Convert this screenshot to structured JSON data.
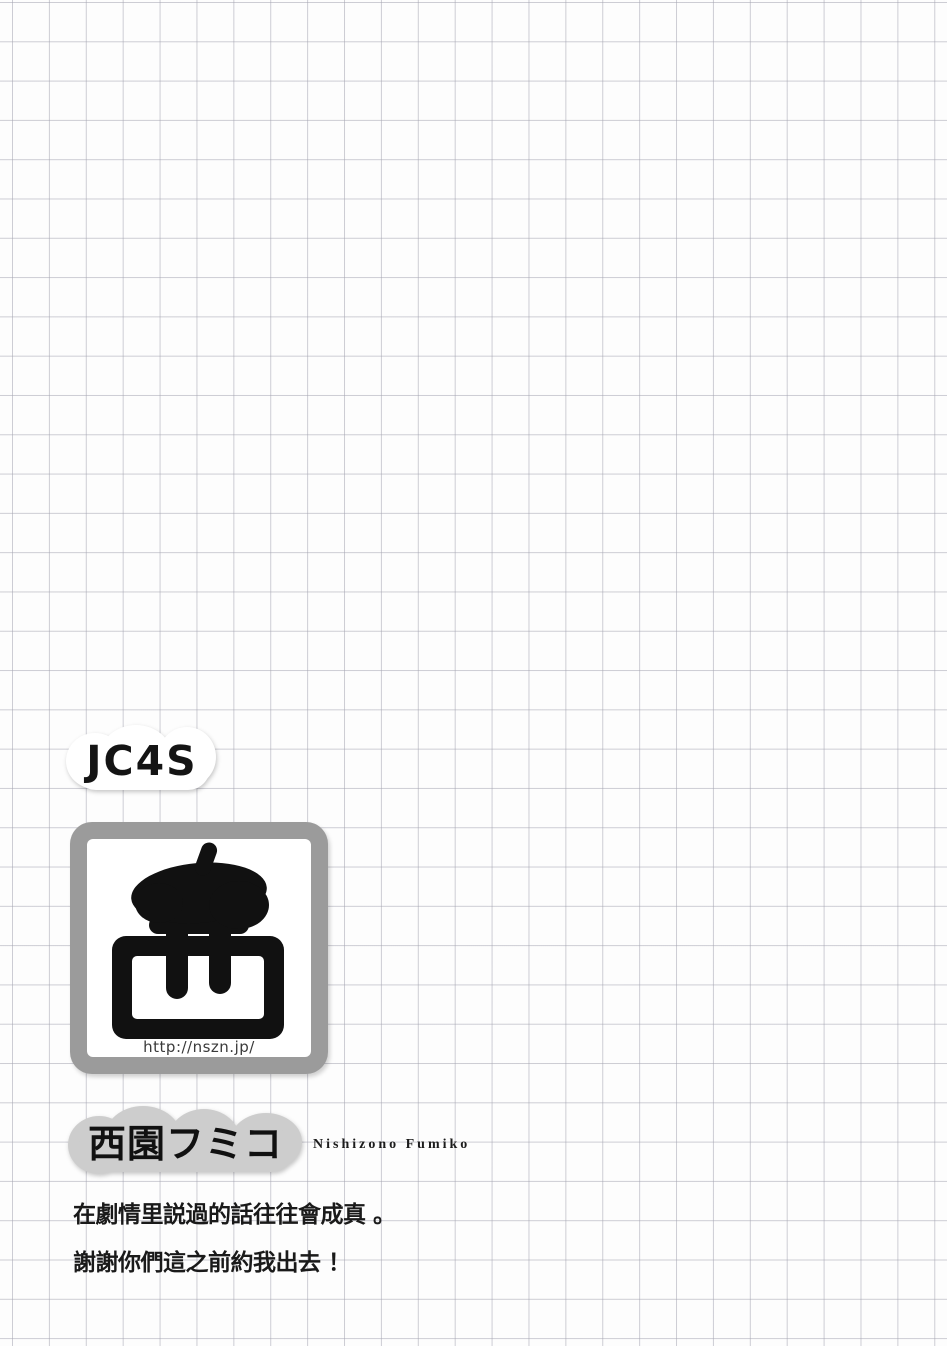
{
  "page": {
    "bg_color": "#fdfdfd",
    "grid_line_color": "#c4c4cb",
    "description": "manga afterword page on squared grid paper"
  },
  "badge": {
    "label": "JC4S"
  },
  "logo": {
    "icon": "beret-artist-glyph-icon",
    "url": "http://nszn.jp/",
    "frame_color": "#9b9b9b",
    "glyph_color": "#111111"
  },
  "author": {
    "name": "西園フミコ",
    "romaji": "Nishizono Fumiko",
    "cloud_color": "#cdcdcd"
  },
  "afterword": {
    "line1": "在劇情里説過的話往往會成真 。",
    "line2": "謝謝你們這之前約我出去 ！"
  }
}
